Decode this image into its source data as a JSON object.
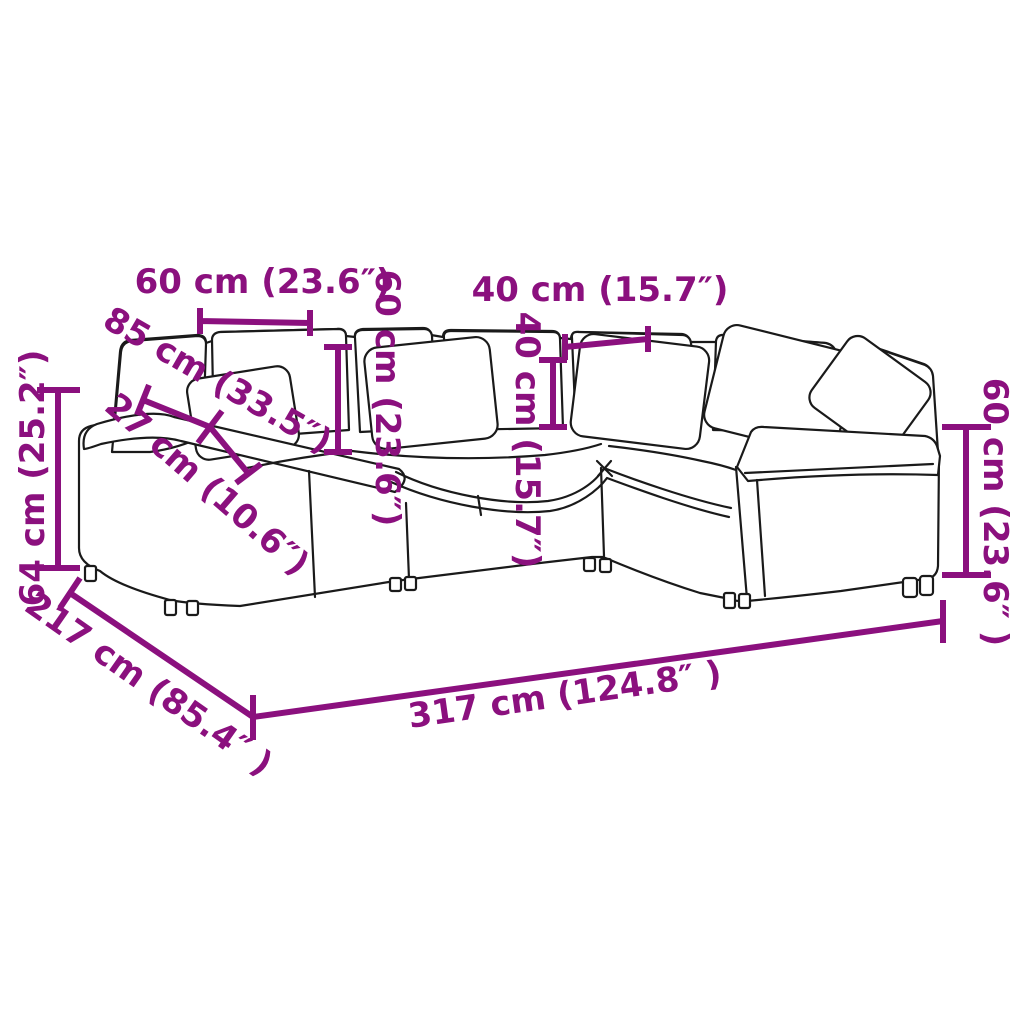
{
  "diagram": {
    "figure_type": "product-dimension-diagram",
    "subject": "modular corner sofa with back cushions and throw pillows",
    "background_color": "#ffffff",
    "line_color": "#1a1a1a",
    "dimension_color": "#8B107E",
    "labels": {
      "module_width": "60 cm (23.6″)",
      "backrest_height": "60 cm (23.6″)",
      "pillow_width": "40 cm (15.7″)",
      "pillow_height": "40 cm (15.7″)",
      "seat_depth": "85 cm (33.5″)",
      "armrest_width": "27 cm (10.6″)",
      "total_height": "64 cm (25.2″)",
      "total_depth": "217 cm (85.4″ )",
      "total_width": "317 cm (124.8″ )",
      "armrest_height": "60 cm (23.6″ )"
    }
  }
}
